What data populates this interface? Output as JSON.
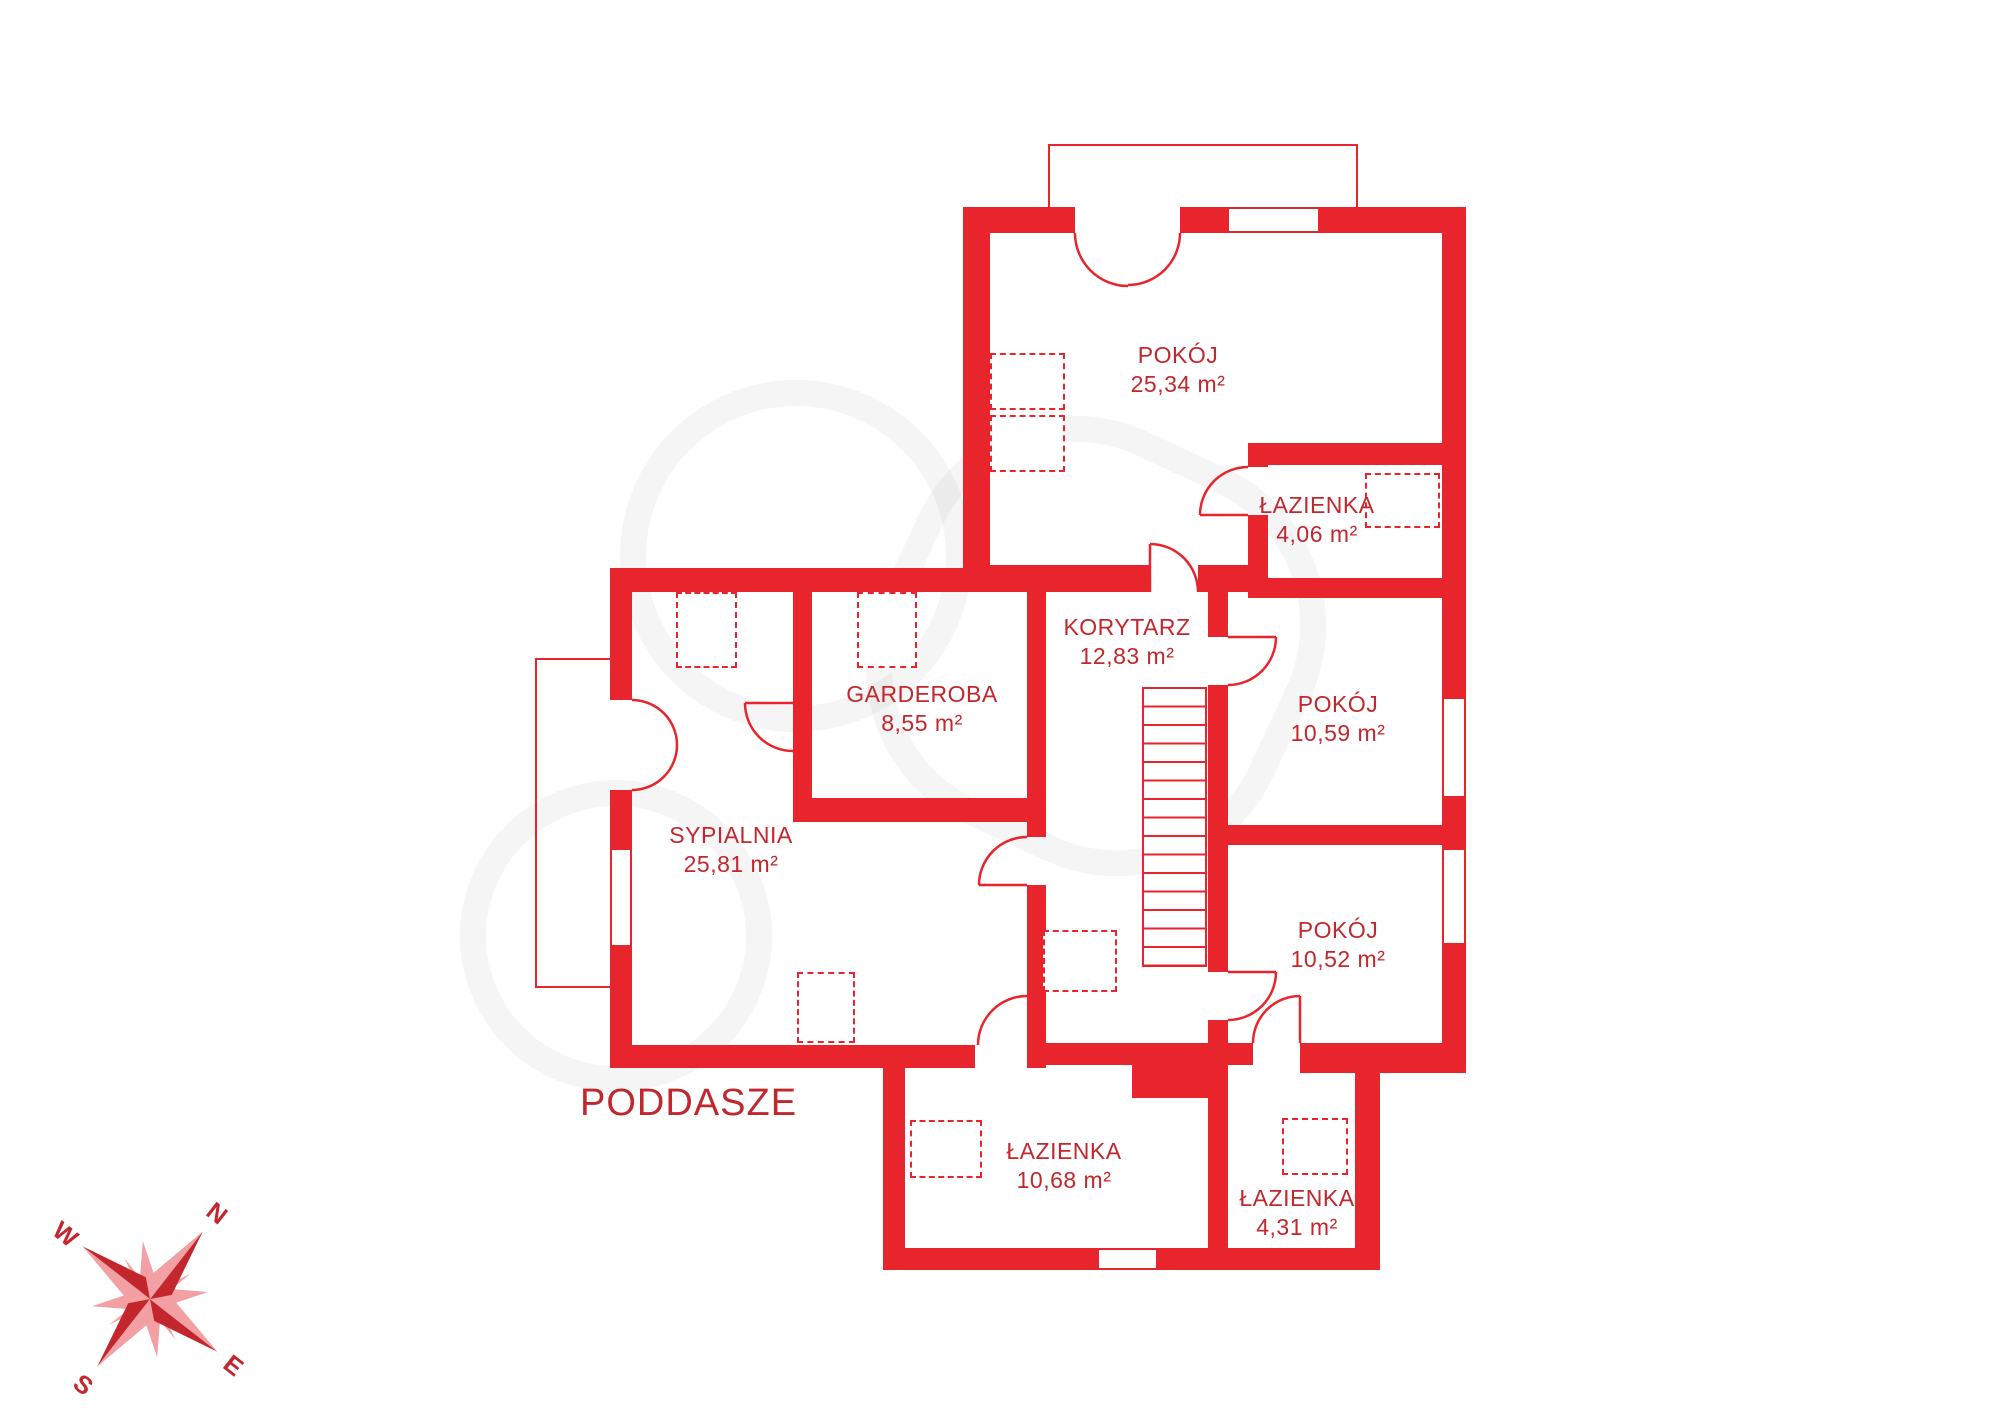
{
  "title": "PODDASZE",
  "rooms": [
    {
      "name": "POKÓJ",
      "area": "25,34 m²"
    },
    {
      "name": "ŁAZIENKA",
      "area": "4,06 m²"
    },
    {
      "name": "KORYTARZ",
      "area": "12,83 m²"
    },
    {
      "name": "GARDEROBA",
      "area": "8,55 m²"
    },
    {
      "name": "POKÓJ",
      "area": "10,59 m²"
    },
    {
      "name": "SYPIALNIA",
      "area": "25,81 m²"
    },
    {
      "name": "POKÓJ",
      "area": "10,52 m²"
    },
    {
      "name": "ŁAZIENKA",
      "area": "10,68 m²"
    },
    {
      "name": "ŁAZIENKA",
      "area": "4,31 m²"
    }
  ],
  "compass": {
    "n": "N",
    "e": "E",
    "s": "S",
    "w": "W"
  },
  "colors": {
    "wall": "#e8242c",
    "label": "#c1272d",
    "compass_dark": "#c4262e",
    "compass_light": "#f2a0a4"
  }
}
